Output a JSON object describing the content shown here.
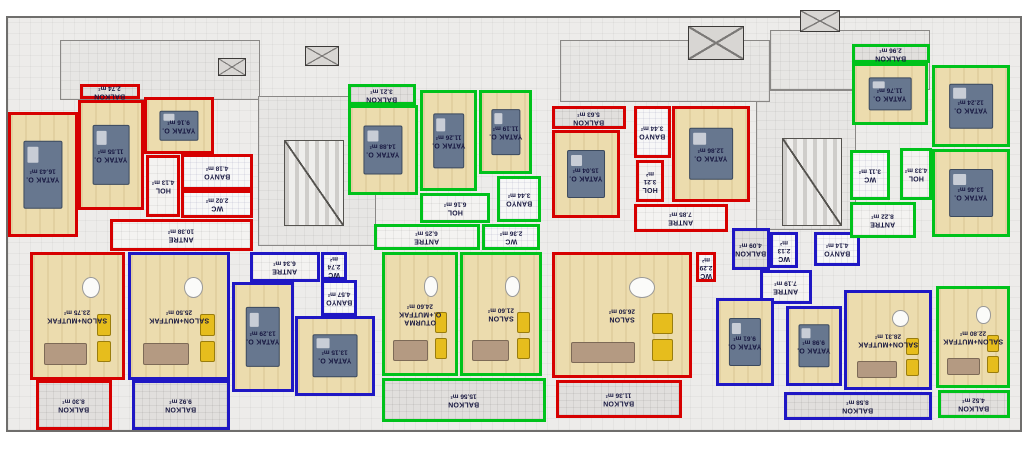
{
  "title": "apartment-floor-plan",
  "units": {
    "area_unit": "m²"
  },
  "colors": {
    "red_unit_outline": "#d60000",
    "green_unit_outline": "#00c21b",
    "blue_unit_outline": "#1f17c4",
    "wall": "#222222",
    "wood_floor": "#ecdcae",
    "balcony_floor": "#e1dfdd",
    "label_text": "#16163f"
  },
  "building": {
    "x": 6,
    "y": 16,
    "w": 1012,
    "h": 412
  },
  "common": {
    "corridors": [
      {
        "name": "corridor-top-left",
        "x": 60,
        "y": 40,
        "w": 200,
        "h": 60
      },
      {
        "name": "corridor-center-left",
        "x": 258,
        "y": 96,
        "w": 118,
        "h": 150
      },
      {
        "name": "corridor-center-right",
        "x": 756,
        "y": 90,
        "w": 100,
        "h": 140
      },
      {
        "name": "corridor-top-center",
        "x": 560,
        "y": 40,
        "w": 210,
        "h": 62
      },
      {
        "name": "corridor-top-right",
        "x": 770,
        "y": 30,
        "w": 160,
        "h": 60
      }
    ],
    "stairs": [
      {
        "name": "staircase-left",
        "x": 284,
        "y": 140,
        "w": 60,
        "h": 86
      },
      {
        "name": "staircase-right",
        "x": 782,
        "y": 138,
        "w": 60,
        "h": 88
      }
    ],
    "shafts": [
      {
        "name": "shaft-a",
        "x": 218,
        "y": 58,
        "w": 28,
        "h": 18
      },
      {
        "name": "shaft-b",
        "x": 305,
        "y": 46,
        "w": 34,
        "h": 20
      },
      {
        "name": "shaft-c",
        "x": 688,
        "y": 26,
        "w": 56,
        "h": 34
      },
      {
        "name": "shaft-d",
        "x": 800,
        "y": 10,
        "w": 40,
        "h": 22
      }
    ]
  },
  "apartments": [
    {
      "id": "unit-1-red-left",
      "outline": "#d60000",
      "rooms": [
        {
          "name": "BALKON",
          "area": "2.74 m²",
          "kind": "balcony",
          "x": 80,
          "y": 84,
          "w": 60,
          "h": 15
        },
        {
          "name": "YATAK O.",
          "area": "16.43 m²",
          "kind": "wood",
          "furniture": "bed",
          "x": 8,
          "y": 112,
          "w": 70,
          "h": 125
        },
        {
          "name": "YATAK O.",
          "area": "11.55 m²",
          "kind": "wood",
          "furniture": "bed",
          "x": 78,
          "y": 100,
          "w": 66,
          "h": 110
        },
        {
          "name": "YATAK O.",
          "area": "9.16 m²",
          "kind": "wood",
          "furniture": "bed",
          "x": 144,
          "y": 97,
          "w": 70,
          "h": 57
        },
        {
          "name": "HOL",
          "area": "4.13 m²",
          "kind": "hall",
          "x": 146,
          "y": 155,
          "w": 34,
          "h": 62
        },
        {
          "name": "BANYO",
          "area": "4.18 m²",
          "kind": "wet",
          "x": 181,
          "y": 154,
          "w": 72,
          "h": 36
        },
        {
          "name": "WC",
          "area": "2.02 m²",
          "kind": "wet",
          "x": 181,
          "y": 190,
          "w": 72,
          "h": 28
        },
        {
          "name": "ANTRE",
          "area": "10.38 m²",
          "kind": "hall",
          "x": 110,
          "y": 219,
          "w": 143,
          "h": 32
        },
        {
          "name": "SALON+MUTFAK",
          "area": "23.75 m²",
          "kind": "wood",
          "furniture": "sofa",
          "x": 30,
          "y": 252,
          "w": 95,
          "h": 128
        },
        {
          "name": "BALKON",
          "area": "8.30 m²",
          "kind": "balcony",
          "x": 36,
          "y": 380,
          "w": 76,
          "h": 50
        }
      ]
    },
    {
      "id": "unit-2-blue-left",
      "outline": "#1f17c4",
      "rooms": [
        {
          "name": "SALON+MUTFAK",
          "area": "25.50 m²",
          "kind": "wood",
          "furniture": "sofa",
          "x": 128,
          "y": 252,
          "w": 102,
          "h": 128
        },
        {
          "name": "ANTRE",
          "area": "6.34 m²",
          "kind": "hall",
          "x": 250,
          "y": 252,
          "w": 70,
          "h": 30
        },
        {
          "name": "WC",
          "area": "2.74 m²",
          "kind": "wet",
          "x": 321,
          "y": 252,
          "w": 26,
          "h": 28
        },
        {
          "name": "BANYO",
          "area": "4.57 m²",
          "kind": "wet",
          "x": 321,
          "y": 280,
          "w": 36,
          "h": 36
        },
        {
          "name": "YATAK O.",
          "area": "13.29 m²",
          "kind": "wood",
          "furniture": "bed",
          "x": 232,
          "y": 282,
          "w": 62,
          "h": 110
        },
        {
          "name": "YATAK O.",
          "area": "13.15 m²",
          "kind": "wood",
          "furniture": "bed",
          "x": 295,
          "y": 316,
          "w": 80,
          "h": 80
        },
        {
          "name": "BALKON",
          "area": "9.92 m²",
          "kind": "balcony",
          "x": 132,
          "y": 380,
          "w": 98,
          "h": 50
        }
      ]
    },
    {
      "id": "unit-3-green-center",
      "outline": "#00c21b",
      "rooms": [
        {
          "name": "BALKON",
          "area": "3.21 m²",
          "kind": "balcony",
          "x": 348,
          "y": 84,
          "w": 68,
          "h": 21
        },
        {
          "name": "YATAK O.",
          "area": "14.88 m²",
          "kind": "wood",
          "furniture": "bed",
          "x": 348,
          "y": 105,
          "w": 70,
          "h": 90
        },
        {
          "name": "YATAK O.",
          "area": "11.26 m²",
          "kind": "wood",
          "furniture": "bed",
          "x": 420,
          "y": 90,
          "w": 57,
          "h": 101
        },
        {
          "name": "YATAK O.",
          "area": "11.19 m²",
          "kind": "wood",
          "furniture": "bed",
          "x": 479,
          "y": 90,
          "w": 53,
          "h": 84
        },
        {
          "name": "HOL",
          "area": "6.16 m²",
          "kind": "hall",
          "x": 420,
          "y": 193,
          "w": 70,
          "h": 30
        },
        {
          "name": "BANYO",
          "area": "3.44 m²",
          "kind": "wet",
          "x": 497,
          "y": 176,
          "w": 44,
          "h": 46
        },
        {
          "name": "ANTRE",
          "area": "6.25 m²",
          "kind": "hall",
          "x": 374,
          "y": 224,
          "w": 106,
          "h": 26
        },
        {
          "name": "WC",
          "area": "2.36 m²",
          "kind": "wet",
          "x": 482,
          "y": 224,
          "w": 58,
          "h": 26
        },
        {
          "name": "OTURMA O.+MUTFAK",
          "area": "24.60 m²",
          "kind": "wood",
          "furniture": "sofa",
          "x": 382,
          "y": 252,
          "w": 76,
          "h": 124
        },
        {
          "name": "SALON",
          "area": "21.60 m²",
          "kind": "wood",
          "furniture": "sofa",
          "x": 460,
          "y": 252,
          "w": 82,
          "h": 124
        },
        {
          "name": "BALKON",
          "area": "15.56 m²",
          "kind": "balcony",
          "x": 382,
          "y": 378,
          "w": 164,
          "h": 44
        }
      ]
    },
    {
      "id": "unit-4-red-center",
      "outline": "#d60000",
      "rooms": [
        {
          "name": "BALKON",
          "area": "5.63 m²",
          "kind": "balcony",
          "x": 552,
          "y": 106,
          "w": 74,
          "h": 23
        },
        {
          "name": "YATAK O.",
          "area": "15.04 m²",
          "kind": "wood",
          "furniture": "bed",
          "x": 552,
          "y": 130,
          "w": 68,
          "h": 88
        },
        {
          "name": "BANYO",
          "area": "3.44 m²",
          "kind": "wet",
          "x": 634,
          "y": 106,
          "w": 37,
          "h": 52
        },
        {
          "name": "HOL",
          "area": "3.21 m²",
          "kind": "hall",
          "x": 636,
          "y": 160,
          "w": 28,
          "h": 42
        },
        {
          "name": "YATAK O.",
          "area": "12.86 m²",
          "kind": "wood",
          "furniture": "bed",
          "x": 672,
          "y": 106,
          "w": 78,
          "h": 96
        },
        {
          "name": "ANTRE",
          "area": "7.85 m²",
          "kind": "hall",
          "x": 634,
          "y": 204,
          "w": 94,
          "h": 28
        },
        {
          "name": "SALON",
          "area": "26.50 m²",
          "kind": "wood",
          "furniture": "sofa",
          "x": 552,
          "y": 252,
          "w": 140,
          "h": 126
        },
        {
          "name": "WC",
          "area": "2.29 m²",
          "kind": "wet",
          "x": 696,
          "y": 252,
          "w": 20,
          "h": 30
        },
        {
          "name": "BALKON",
          "area": "11.36 m²",
          "kind": "balcony",
          "x": 556,
          "y": 380,
          "w": 126,
          "h": 38
        }
      ]
    },
    {
      "id": "unit-5-blue-right",
      "outline": "#1f17c4",
      "rooms": [
        {
          "name": "BALKON",
          "area": "4.09 m²",
          "kind": "balcony",
          "x": 732,
          "y": 228,
          "w": 38,
          "h": 42
        },
        {
          "name": "WC",
          "area": "2.13 m²",
          "kind": "wet",
          "x": 770,
          "y": 232,
          "w": 28,
          "h": 36
        },
        {
          "name": "BANYO",
          "area": "4.14 m²",
          "kind": "wet",
          "x": 814,
          "y": 232,
          "w": 46,
          "h": 34
        },
        {
          "name": "ANTRE",
          "area": "7.19 m²",
          "kind": "hall",
          "x": 760,
          "y": 270,
          "w": 52,
          "h": 34
        },
        {
          "name": "YATAK O.",
          "area": "9.61 m²",
          "kind": "wood",
          "furniture": "bed",
          "x": 716,
          "y": 298,
          "w": 58,
          "h": 88
        },
        {
          "name": "YATAK O.",
          "area": "9.98 m²",
          "kind": "wood",
          "furniture": "bed",
          "x": 786,
          "y": 306,
          "w": 56,
          "h": 80
        },
        {
          "name": "SALON+MUTFAK",
          "area": "28.31 m²",
          "kind": "wood",
          "furniture": "sofa",
          "x": 844,
          "y": 290,
          "w": 88,
          "h": 100
        },
        {
          "name": "BALKON",
          "area": "8.58 m²",
          "kind": "balcony",
          "x": 784,
          "y": 392,
          "w": 148,
          "h": 28
        }
      ]
    },
    {
      "id": "unit-6-green-right",
      "outline": "#00c21b",
      "rooms": [
        {
          "name": "BALKON",
          "area": "2.96 m²",
          "kind": "balcony",
          "x": 852,
          "y": 44,
          "w": 78,
          "h": 19
        },
        {
          "name": "YATAK O.",
          "area": "11.76 m²",
          "kind": "wood",
          "furniture": "bed",
          "x": 852,
          "y": 63,
          "w": 76,
          "h": 62
        },
        {
          "name": "YATAK O.",
          "area": "12.24 m²",
          "kind": "wood",
          "furniture": "bed",
          "x": 932,
          "y": 65,
          "w": 78,
          "h": 82
        },
        {
          "name": "HOL",
          "area": "4.33 m²",
          "kind": "hall",
          "x": 900,
          "y": 148,
          "w": 32,
          "h": 52
        },
        {
          "name": "WC",
          "area": "3.11 m²",
          "kind": "wet",
          "x": 850,
          "y": 150,
          "w": 40,
          "h": 50
        },
        {
          "name": "YATAK O.",
          "area": "13.46 m²",
          "kind": "wood",
          "furniture": "bed",
          "x": 932,
          "y": 149,
          "w": 78,
          "h": 88
        },
        {
          "name": "ANTRE",
          "area": "8.22 m²",
          "kind": "hall",
          "x": 850,
          "y": 202,
          "w": 66,
          "h": 36
        },
        {
          "name": "SALON+MUTFAK",
          "area": "22.80 m²",
          "kind": "wood",
          "furniture": "sofa",
          "x": 936,
          "y": 286,
          "w": 74,
          "h": 102
        },
        {
          "name": "BALKON",
          "area": "4.52 m²",
          "kind": "balcony",
          "x": 938,
          "y": 390,
          "w": 72,
          "h": 28
        }
      ]
    }
  ]
}
